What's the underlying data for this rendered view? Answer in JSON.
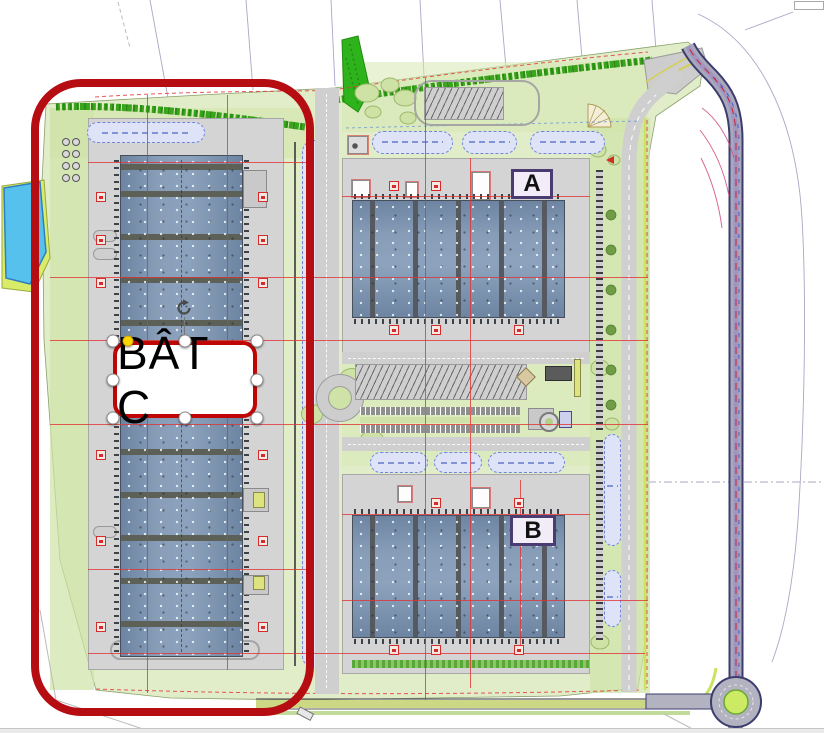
{
  "annotation": {
    "label_text": "BÂT C",
    "highlight_color": "#b60d12",
    "label_border_color": "#c00505",
    "active_handle_color": "#ffd400",
    "handle_names": [
      "top-left",
      "top-center",
      "top-right",
      "middle-left",
      "middle-right",
      "bottom-left",
      "bottom-center",
      "bottom-right"
    ],
    "rotate_icon": "rotate-handle-icon"
  },
  "plan": {
    "building_a_label": "A",
    "building_b_label": "B",
    "colors": {
      "site_green": "#e0edc8",
      "hedge_green": "#38a51d",
      "roof_blue": "#7b93af",
      "ridge_gray": "#585c62",
      "apron_gray": "#d4d4d4",
      "basin_lavender": "#dfe3f7",
      "basin_border_blue": "#7085d8",
      "pond_blue": "#57c1ee",
      "pond_rim_green": "#d9ec69",
      "cad_red": "#e03434",
      "road_edge_purple": "#3c3c6e",
      "roundabout_green": "#cdea64"
    }
  }
}
